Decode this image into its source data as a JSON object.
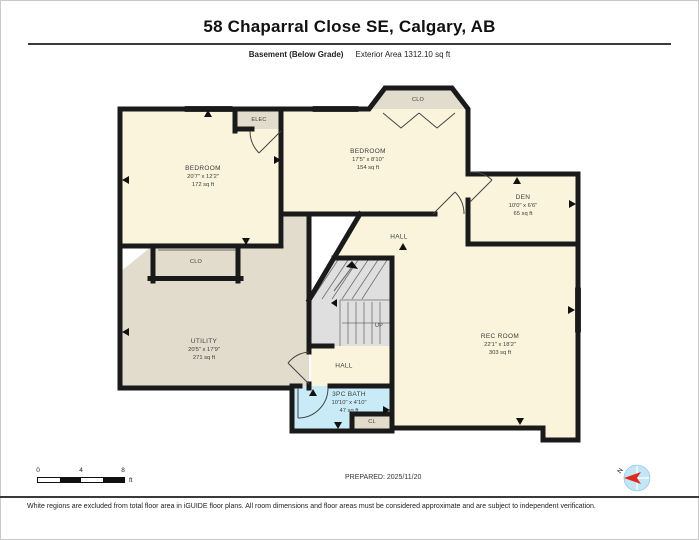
{
  "title": "58 Chaparral Close SE, Calgary, AB",
  "subtitle": {
    "floor_label": "Basement (Below Grade)",
    "area_label": "Exterior Area 1312.10 sq ft"
  },
  "rooms": [
    {
      "name": "BEDROOM",
      "dims": "20'7\" x 12'2\"",
      "area": "172 sq ft"
    },
    {
      "name": "BEDROOM",
      "dims": "17'5\" x 8'10\"",
      "area": "154 sq ft"
    },
    {
      "name": "DEN",
      "dims": "10'0\" x 6'6\"",
      "area": "65 sq ft"
    },
    {
      "name": "HALL"
    },
    {
      "name": "REC ROOM",
      "dims": "22'1\" x 18'2\"",
      "area": "303 sq ft"
    },
    {
      "name": "UTILITY",
      "dims": "20'5\" x 17'9\"",
      "area": "271 sq ft"
    },
    {
      "name": "HALL"
    },
    {
      "name": "3PC BATH",
      "dims": "10'10\" x 4'10\"",
      "area": "47 sq ft"
    }
  ],
  "closets": {
    "bay": "CLO",
    "elec": "ELEC",
    "bedroom": "CLO",
    "bath": "CL"
  },
  "stairs": {
    "up_label": "UP"
  },
  "scalebar": {
    "tick0": "0",
    "tick1": "4",
    "tick2": "8",
    "unit": "ft"
  },
  "prepared_label": "PREPARED: 2025/11/20",
  "compass": {
    "north_label": "N"
  },
  "footer_note": "White regions are excluded from total floor area in iGUIDE floor plans. All room dimensions and floor areas must be considered approximate and are subject to independent verification.",
  "colors": {
    "floor_cream": "#FAF4DC",
    "floor_tan": "#E2DCCC",
    "bath_blue": "#C9EBF7",
    "window_cyan": "#54C3E6",
    "wall": "#1A1A1A",
    "stairs_gray": "#DFDFDF",
    "compass_blue": "#C2E6F5",
    "compass_red": "#DD2B20"
  }
}
